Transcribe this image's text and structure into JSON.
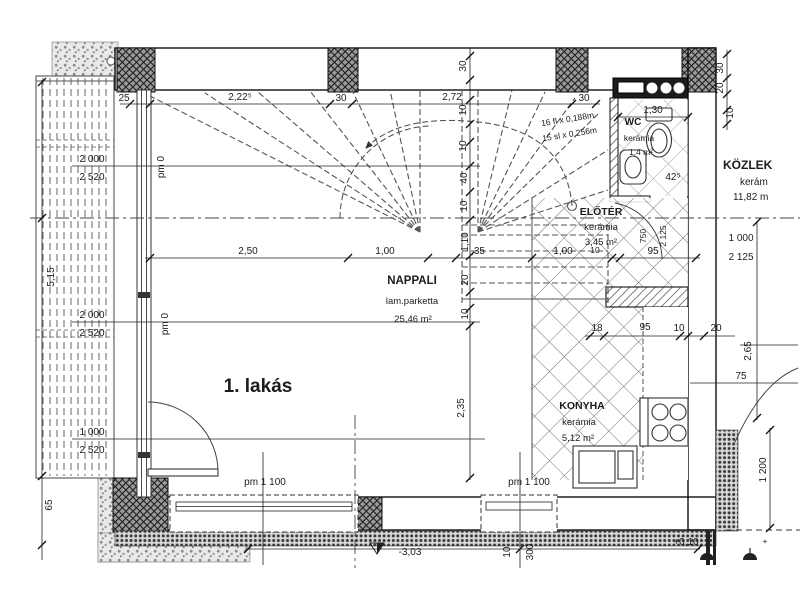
{
  "drawing": {
    "apartment_label": "1. lakás",
    "rooms": {
      "nappali": {
        "name": "NAPPALI",
        "finish": "lam.parketta",
        "area": "25,46 m²"
      },
      "eloter": {
        "name": "ELŐTÉR",
        "finish": "kerámia",
        "area": "3,45 m²"
      },
      "konyha": {
        "name": "KONYHA",
        "finish": "kerámia",
        "area": "5,12 m²"
      },
      "wc": {
        "name": "WC",
        "finish": "kerámia",
        "area": "1,4 m²"
      },
      "kozlek": {
        "name": "KÖZLEK",
        "finish": "kerám",
        "area": "11,82 m"
      }
    },
    "stair_notes": [
      "16 fl x 0,188m",
      "15 sl x 0,256m"
    ],
    "levels": {
      "pm0_a": "pm 0",
      "pm0_b": "pm 0",
      "pm1100_a": "pm 1 100",
      "pm1100_b": "pm 1 100",
      "terrace_level": "-3,03",
      "entry_level": "+0,10"
    },
    "openings": {
      "win1_w": "2 000",
      "win1_h": "2 520",
      "win2_w": "2 000",
      "win2_h": "2 520",
      "door1_w": "1 000",
      "door1_h": "2 520",
      "right_w": "1 000",
      "right_h": "2 125",
      "wcdoor_w": "750",
      "wcdoor_h": "2 125"
    },
    "dims": {
      "top": [
        "25",
        "2,22⁵",
        "30",
        "2,72",
        "30"
      ],
      "wc_width": "1,30",
      "wc_corner": "42⁵",
      "right_top": [
        "30",
        "20",
        "10"
      ],
      "mid_h": [
        "2,50",
        "1,00",
        ",35",
        "1,00",
        "10",
        "95"
      ],
      "stair_v": [
        "30",
        "10",
        "10",
        "40",
        "10",
        "1,10",
        "20",
        "10",
        "2,35"
      ],
      "kitchen_h": [
        "18",
        "95",
        "10",
        "20"
      ],
      "right_side": [
        "2,65",
        "75",
        "1 200"
      ],
      "left_side": [
        "5,15",
        "65"
      ],
      "bottom_v": [
        "10",
        "300"
      ]
    }
  }
}
